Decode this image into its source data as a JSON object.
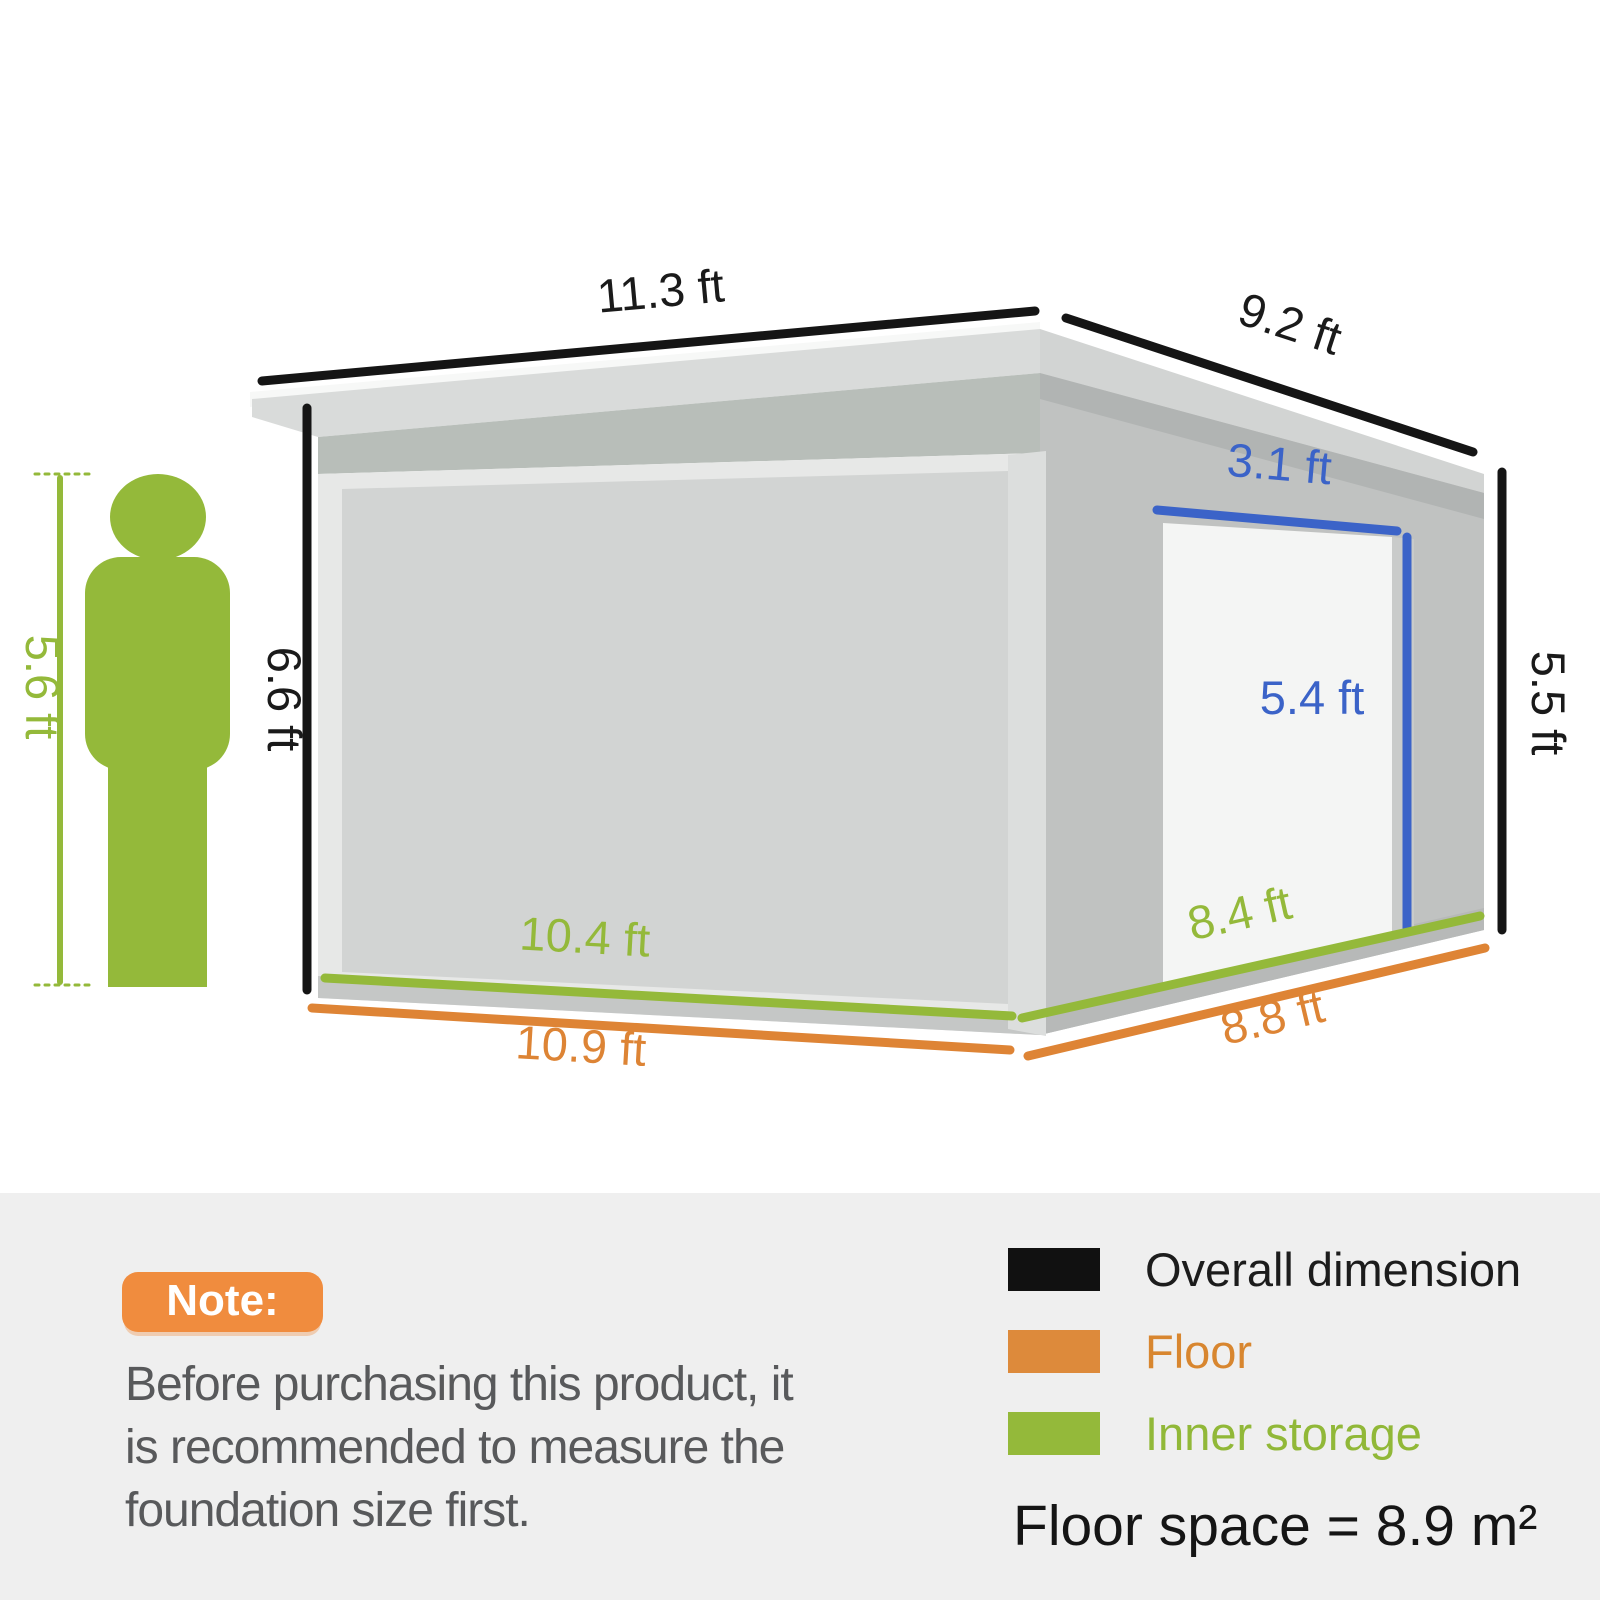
{
  "diagram": {
    "dim_roof_front": "11.3 ft",
    "dim_roof_side": "9.2 ft",
    "dim_wall_left_height": "6.6 ft",
    "dim_wall_right_height": "5.5 ft",
    "dim_door_width": "3.1 ft",
    "dim_door_height": "5.4 ft",
    "dim_inner_front": "10.4 ft",
    "dim_inner_side": "8.4 ft",
    "dim_floor_front": "10.9 ft",
    "dim_floor_side": "8.8 ft",
    "dim_person_height": "5.6 ft",
    "colors": {
      "overall_dimension": "#151515",
      "floor": "#de8435",
      "inner_storage": "#94b93a",
      "door_dimension": "#3b63c8",
      "person": "#94b93a"
    }
  },
  "note": {
    "badge_label": "Note:",
    "lines": [
      "Before purchasing this product, it",
      "is recommended to measure the",
      "foundation size first."
    ]
  },
  "legend": {
    "items": [
      {
        "label": "Overall dimension",
        "color": "#111111"
      },
      {
        "label": "Floor",
        "color": "#dd8a3b"
      },
      {
        "label": "Inner storage",
        "color": "#94b93a"
      }
    ],
    "floor_space": "Floor space = 8.9 m²"
  }
}
